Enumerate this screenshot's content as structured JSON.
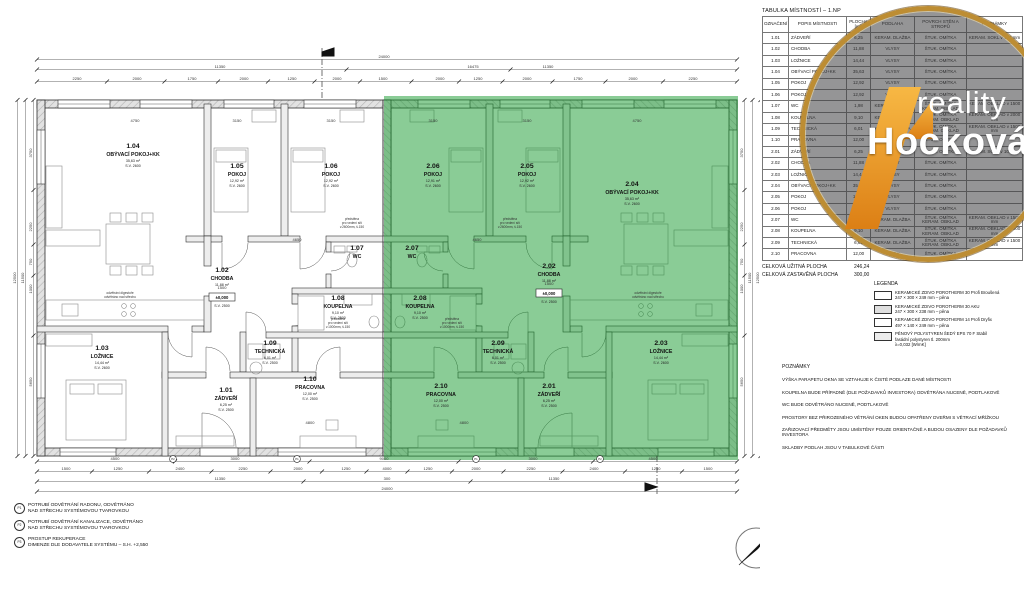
{
  "logo": {
    "word1": "reality",
    "word2": "Hocková"
  },
  "compass": {
    "label": "S"
  },
  "room_table": {
    "title": "TABULKA MÍSTNOSTÍ  –  1.NP",
    "columns": [
      "OZNAČENÍ",
      "POPIS MÍSTNOSTI",
      "PLOCHA [m²]",
      "PODLAHA",
      "POVRCH STĚN A STROPŮ",
      "POZNÁMKY"
    ],
    "rows": [
      [
        "1.01",
        "ZÁDVEŘÍ",
        "6,25",
        "KERAM. DLAŽBA",
        "ŠTUK. OMÍTKA",
        "KERAM. SOKL v 100 mm"
      ],
      [
        "1.02",
        "CHODBA",
        "11,88",
        "VLYSY",
        "ŠTUK. OMÍTKA",
        ""
      ],
      [
        "1.03",
        "LOŽNICE",
        "14,44",
        "VLYSY",
        "ŠTUK. OMÍTKA",
        ""
      ],
      [
        "1.04",
        "OBÝVACÍ POKOJ+KK",
        "35,63",
        "VLYSY",
        "ŠTUK. OMÍTKA",
        ""
      ],
      [
        "1.05",
        "POKOJ",
        "12,92",
        "VLYSY",
        "ŠTUK. OMÍTKA",
        ""
      ],
      [
        "1.06",
        "POKOJ",
        "12,92",
        "VLYSY",
        "ŠTUK. OMÍTKA",
        ""
      ],
      [
        "1.07",
        "WC",
        "1,98",
        "KERAM. DLAŽBA",
        "ŠTUK. OMÍTKA KERAM. OBKLAD",
        "KERAM. OBKLAD v 1500 mm"
      ],
      [
        "1.08",
        "KOUPELNA",
        "9,10",
        "KERAM. DLAŽBA",
        "ŠTUK. OMÍTKA KERAM. OBKLAD",
        "KERAM. OBKLAD v 2000 mm"
      ],
      [
        "1.09",
        "TECHNICKÁ",
        "6,01",
        "KERAM. DLAŽBA",
        "ŠTUK. OMÍTKA KERAM. OBKLAD",
        "KERAM. OBKLAD v 1500 mm"
      ],
      [
        "1.10",
        "PRACOVNA",
        "12,00",
        "VLYSY",
        "ŠTUK. OMÍTKA",
        ""
      ],
      [
        "2.01",
        "ZÁDVEŘÍ",
        "6,25",
        "KERAM. DLAŽBA",
        "ŠTUK. OMÍTKA",
        "KERAM. SOKL v 100 mm"
      ],
      [
        "2.02",
        "CHODBA",
        "11,88",
        "VLYSY",
        "ŠTUK. OMÍTKA",
        ""
      ],
      [
        "2.03",
        "LOŽNICE",
        "14,44",
        "VLYSY",
        "ŠTUK. OMÍTKA",
        ""
      ],
      [
        "2.04",
        "OBÝVACÍ POKOJ+KK",
        "35,63",
        "VLYSY",
        "ŠTUK. OMÍTKA",
        ""
      ],
      [
        "2.05",
        "POKOJ",
        "12,92",
        "VLYSY",
        "ŠTUK. OMÍTKA",
        ""
      ],
      [
        "2.06",
        "POKOJ",
        "12,91",
        "VLYSY",
        "ŠTUK. OMÍTKA",
        ""
      ],
      [
        "2.07",
        "WC",
        "1,98",
        "KERAM. DLAŽBA",
        "ŠTUK. OMÍTKA KERAM. OBKLAD",
        "KERAM. OBKLAD v 1500 mm"
      ],
      [
        "2.08",
        "KOUPELNA",
        "9,10",
        "KERAM. DLAŽBA",
        "ŠTUK. OMÍTKA KERAM. OBKLAD",
        "KERAM. OBKLAD v 2000 mm"
      ],
      [
        "2.09",
        "TECHNICKÁ",
        "6,01",
        "KERAM. DLAŽBA",
        "ŠTUK. OMÍTKA KERAM. OBKLAD",
        "KERAM. OBKLAD v 1500 mm"
      ],
      [
        "2.10",
        "PRACOVNA",
        "12,00",
        "VLYSY",
        "ŠTUK. OMÍTKA",
        ""
      ]
    ],
    "totals": [
      {
        "label": "CELKOVÁ UŽITNÁ PLOCHA",
        "value": "246,24"
      },
      {
        "label": "CELKOVÁ ZASTAVĚNÁ PLOCHA",
        "value": "300,00"
      }
    ]
  },
  "legend": {
    "title": "LEGENDA",
    "items": [
      {
        "swatch": "sw1",
        "lines": [
          "KERAMICKÉ ZDIVO POROTHERM 30 Profi Broušená",
          "247 × 300 × 249 mm – pěna"
        ]
      },
      {
        "swatch": "sw2",
        "lines": [
          "KERAMICKÉ ZDIVO POROTHERM 30 AKU",
          "247 × 300 × 238 mm – pěna"
        ]
      },
      {
        "swatch": "sw3",
        "lines": [
          "KERAMICKÉ ZDIVO POROTHERM 14 Profi Dryfix",
          "497 × 140 × 249 mm – pěna"
        ]
      },
      {
        "swatch": "sw4",
        "lines": [
          "PĚNOVÝ POLYSTYREN ŠEDÝ EPS 70 F Stabil",
          "fasádní polystyren tl. 200mm",
          "λ=0,032 [W/mK]"
        ]
      }
    ]
  },
  "notes": {
    "title": "POZNÁMKY",
    "lines": [
      "VÝŠKA PARAPETU OKNA SE VZTAHUJE K ČISTÉ PODLAZE DANÉ MÍSTNOSTI",
      "KOUPELNA BUDE PŘÍPADNĚ (DLE POŽADAVKŮ INVESTORA) ODVĚTRÁNA NUCENĚ, PODTLAKOVĚ",
      "WC BUDE ODVĚTRÁNO NUCENĚ, PODTLAKOVĚ",
      "PROSTORY BEZ PŘIROZENÉHO VĚTRÁNÍ OKEN BUDOU OPATŘENY DVEŘMI S VĚTRACÍ MŘÍŽKOU",
      "ZAŘIZOVACÍ PŘEDMĚTY JSOU UMÍSTĚNY POUZE ORIENTAČNĚ A BUDOU OSAZENY DLE POŽADAVKŮ INVESTORA",
      "SKLADBY PODLAH JSOU V TABULKOVÉ ČÁSTI"
    ]
  },
  "site_notes": {
    "items": [
      {
        "tag": "P1",
        "lines": [
          "POTRUBÍ ODVĚTRÁNÍ RADONU, ODVĚTRÁNO",
          "NAD STŘECHU SYSTÉMOVOU TVAROVKOU"
        ]
      },
      {
        "tag": "P2",
        "lines": [
          "POTRUBÍ ODVĚTRÁNÍ KANALIZACE, ODVĚTRÁNO",
          "NAD STŘECHU SYSTÉMOVOU TVAROVKOU"
        ]
      },
      {
        "tag": "P3",
        "lines": [
          "PROSTUP REKUPERACE",
          "DIMENZE DLE DODAVATELE SYSTÉMU – S.H. +2,550"
        ]
      }
    ]
  },
  "plan": {
    "highlight": {
      "color": "#169a2e",
      "opacity": 0.5
    },
    "rooms": [
      {
        "id": "1.01",
        "name": "ZÁDVEŘÍ",
        "area": "6,25 m²",
        "sv": "S.V. 2500",
        "x": 226,
        "y": 392
      },
      {
        "id": "1.02",
        "name": "CHODBA",
        "area": "11,88 m²",
        "sv": "",
        "x": 222,
        "y": 272
      },
      {
        "id": "1.03",
        "name": "LOŽNICE",
        "area": "14,44 m²",
        "sv": "S.V. 2600",
        "x": 102,
        "y": 350
      },
      {
        "id": "1.04",
        "name": "OBÝVACÍ POKOJ+KK",
        "area": "35,63 m²",
        "sv": "S.V. 2600",
        "x": 133,
        "y": 148
      },
      {
        "id": "1.05",
        "name": "POKOJ",
        "area": "12,92 m²",
        "sv": "S.V. 2600",
        "x": 237,
        "y": 168
      },
      {
        "id": "1.06",
        "name": "POKOJ",
        "area": "12,92 m²",
        "sv": "S.V. 2600",
        "x": 331,
        "y": 168
      },
      {
        "id": "1.07",
        "name": "WC",
        "area": "",
        "sv": "",
        "x": 357,
        "y": 250
      },
      {
        "id": "1.08",
        "name": "KOUPELNA",
        "area": "9,10 m²",
        "sv": "S.V. 2500",
        "x": 338,
        "y": 300
      },
      {
        "id": "1.09",
        "name": "TECHNICKÁ",
        "area": "6,01 m²",
        "sv": "S.V. 2500",
        "x": 270,
        "y": 345
      },
      {
        "id": "1.10",
        "name": "PRACOVNA",
        "area": "12,00 m²",
        "sv": "S.V. 2500",
        "x": 310,
        "y": 381
      },
      {
        "id": "2.01",
        "name": "ZÁDVEŘÍ",
        "area": "6,25 m²",
        "sv": "S.V. 2500",
        "x": 549,
        "y": 388
      },
      {
        "id": "2.02",
        "name": "CHODBA",
        "area": "11,88 m²",
        "sv": "",
        "x": 549,
        "y": 268
      },
      {
        "id": "2.03",
        "name": "LOŽNICE",
        "area": "14,44 m²",
        "sv": "S.V. 2600",
        "x": 661,
        "y": 345
      },
      {
        "id": "2.04",
        "name": "OBÝVACÍ POKOJ+KK",
        "area": "35,63 m²",
        "sv": "S.V. 2600",
        "x": 632,
        "y": 186
      },
      {
        "id": "2.05",
        "name": "POKOJ",
        "area": "12,92 m²",
        "sv": "S.V. 2600",
        "x": 527,
        "y": 168
      },
      {
        "id": "2.06",
        "name": "POKOJ",
        "area": "12,91 m²",
        "sv": "S.V. 2600",
        "x": 433,
        "y": 168
      },
      {
        "id": "2.07",
        "name": "WC",
        "area": "",
        "sv": "",
        "x": 412,
        "y": 250
      },
      {
        "id": "2.08",
        "name": "KOUPELNA",
        "area": "9,10 m²",
        "sv": "S.V. 2500",
        "x": 420,
        "y": 300
      },
      {
        "id": "2.09",
        "name": "TECHNICKÁ",
        "area": "6,01 m²",
        "sv": "S.V. 2500",
        "x": 498,
        "y": 345
      },
      {
        "id": "2.10",
        "name": "PRACOVNA",
        "area": "12,00 m²",
        "sv": "S.V. 2500",
        "x": 441,
        "y": 388
      }
    ],
    "level_marks": [
      {
        "text": "±0,000",
        "sub": "S.V. 2500",
        "x": 222,
        "y": 299
      },
      {
        "text": "±0,000",
        "sub": "S.V. 2500",
        "x": 549,
        "y": 295
      }
    ],
    "small_notes": [
      {
        "x": 120,
        "y": 294,
        "lines": [
          "odvětrání digestoře",
          "odvětráno nad střechu"
        ]
      },
      {
        "x": 648,
        "y": 294,
        "lines": [
          "odvětrání digestoře",
          "odvětráno nad střechu"
        ]
      },
      {
        "x": 352,
        "y": 220,
        "lines": [
          "předstěna",
          "pro vedení sítí",
          "v.2600mm, š.150"
        ]
      },
      {
        "x": 510,
        "y": 220,
        "lines": [
          "předstěna",
          "pro vedení sítí",
          "v.2600mm, š.150"
        ]
      },
      {
        "x": 338,
        "y": 320,
        "lines": [
          "předstěna",
          "pro vedení sítí",
          "v.1000mm, š.150"
        ]
      },
      {
        "x": 452,
        "y": 320,
        "lines": [
          "předstěna",
          "pro vedení sítí",
          "v.1000mm, š.150"
        ]
      }
    ],
    "interior_dims": [
      {
        "t": "4750",
        "x": 135,
        "y": 122
      },
      {
        "t": "3150",
        "x": 237,
        "y": 122
      },
      {
        "t": "3150",
        "x": 331,
        "y": 122
      },
      {
        "t": "3150",
        "x": 433,
        "y": 122
      },
      {
        "t": "3150",
        "x": 527,
        "y": 122
      },
      {
        "t": "4750",
        "x": 637,
        "y": 122
      },
      {
        "t": "4650",
        "x": 297,
        "y": 241
      },
      {
        "t": "4650",
        "x": 477,
        "y": 241
      },
      {
        "t": "4800",
        "x": 310,
        "y": 424
      },
      {
        "t": "4800",
        "x": 464,
        "y": 424
      },
      {
        "t": "1500",
        "x": 222,
        "y": 289
      },
      {
        "t": "1500",
        "x": 549,
        "y": 285
      }
    ],
    "p_markers": [
      {
        "t": "P2",
        "x": 173,
        "y": 459
      },
      {
        "t": "P1",
        "x": 297,
        "y": 459
      },
      {
        "t": "P1",
        "x": 476,
        "y": 459
      },
      {
        "t": "P2",
        "x": 600,
        "y": 459
      }
    ],
    "dim_rows_h": [
      {
        "y": 57,
        "x1": 37,
        "x2": 737,
        "labels": [
          {
            "t": "24000",
            "x": 384
          }
        ]
      },
      {
        "y": 67,
        "x1": 37,
        "x2": 737,
        "labels": [
          {
            "t": "11350",
            "x": 220
          },
          {
            "t": "16475",
            "x": 473
          },
          {
            "t": "11350",
            "x": 548
          }
        ]
      },
      {
        "y": 79,
        "x1": 37,
        "x2": 737,
        "labels": [
          {
            "t": "2250",
            "x": 77
          },
          {
            "t": "2000",
            "x": 137
          },
          {
            "t": "1750",
            "x": 192
          },
          {
            "t": "2000",
            "x": 244
          },
          {
            "t": "1250",
            "x": 292
          },
          {
            "t": "2000",
            "x": 337
          },
          {
            "t": "1500",
            "x": 383
          },
          {
            "t": "2000",
            "x": 440
          },
          {
            "t": "1250",
            "x": 478
          },
          {
            "t": "2000",
            "x": 527
          },
          {
            "t": "1750",
            "x": 578
          },
          {
            "t": "2000",
            "x": 633
          },
          {
            "t": "2250",
            "x": 693
          }
        ]
      },
      {
        "y": 459,
        "x1": 37,
        "x2": 737,
        "labels": [
          {
            "t": "4500",
            "x": 115
          },
          {
            "t": "3000",
            "x": 235
          },
          {
            "t": "9000",
            "x": 384
          },
          {
            "t": "3000",
            "x": 533
          },
          {
            "t": "4500",
            "x": 653
          }
        ]
      },
      {
        "y": 469,
        "x1": 37,
        "x2": 737,
        "labels": [
          {
            "t": "1500",
            "x": 66
          },
          {
            "t": "1250",
            "x": 118
          },
          {
            "t": "2400",
            "x": 180
          },
          {
            "t": "2250",
            "x": 243
          },
          {
            "t": "2000",
            "x": 298
          },
          {
            "t": "1250",
            "x": 346
          },
          {
            "t": "4000",
            "x": 387
          },
          {
            "t": "1250",
            "x": 428
          },
          {
            "t": "2000",
            "x": 476
          },
          {
            "t": "2250",
            "x": 531
          },
          {
            "t": "2400",
            "x": 594
          },
          {
            "t": "1250",
            "x": 656
          },
          {
            "t": "1500",
            "x": 708
          }
        ]
      },
      {
        "y": 479,
        "x1": 37,
        "x2": 737,
        "labels": [
          {
            "t": "11350",
            "x": 220
          },
          {
            "t": "300",
            "x": 387
          },
          {
            "t": "11350",
            "x": 554
          }
        ]
      },
      {
        "y": 489,
        "x1": 37,
        "x2": 737,
        "labels": [
          {
            "t": "24000",
            "x": 387
          }
        ]
      }
    ],
    "dim_rows_v": [
      {
        "x": 31,
        "y1": 100,
        "y2": 456,
        "labels": [
          {
            "t": "3750",
            "y": 153
          },
          {
            "t": "2250",
            "y": 227
          },
          {
            "t": "750",
            "y": 262
          },
          {
            "t": "1000",
            "y": 289
          },
          {
            "t": "5650",
            "y": 382
          }
        ]
      },
      {
        "x": 23,
        "y1": 100,
        "y2": 456,
        "labels": [
          {
            "t": "11500",
            "y": 278
          }
        ]
      },
      {
        "x": 15,
        "y1": 100,
        "y2": 456,
        "labels": [
          {
            "t": "12500",
            "y": 278
          }
        ]
      },
      {
        "x": 742,
        "y1": 100,
        "y2": 456,
        "labels": [
          {
            "t": "3750",
            "y": 153
          },
          {
            "t": "2250",
            "y": 227
          },
          {
            "t": "750",
            "y": 262
          },
          {
            "t": "1000",
            "y": 289
          },
          {
            "t": "5650",
            "y": 382
          }
        ]
      },
      {
        "x": 750,
        "y1": 100,
        "y2": 456,
        "labels": [
          {
            "t": "11500",
            "y": 278
          }
        ]
      },
      {
        "x": 758,
        "y1": 100,
        "y2": 456,
        "labels": [
          {
            "t": "12500",
            "y": 278
          }
        ]
      }
    ]
  }
}
